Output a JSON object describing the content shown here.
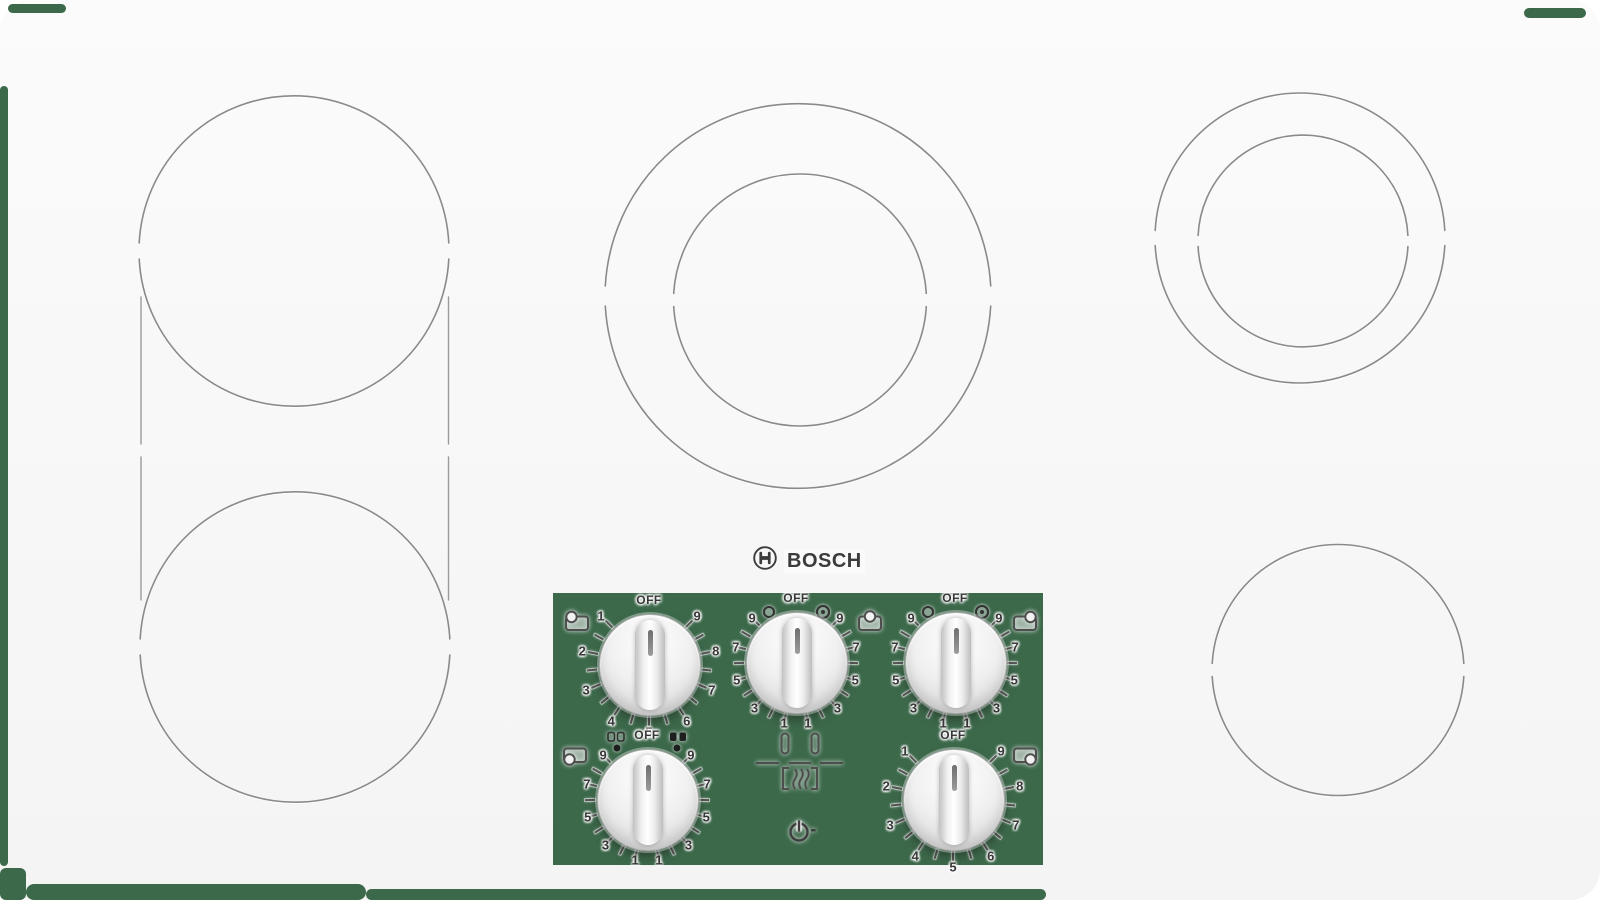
{
  "brand": {
    "name": "BOSCH",
    "icon": "bosch-armature-icon"
  },
  "colors": {
    "surface": "#e6e6e6",
    "frame": "#f9f9f9",
    "ring_line": "#8a8a8a",
    "transparency_green": "#3d694b",
    "label_text": "#383838"
  },
  "burners": [
    {
      "name": "left-rear",
      "style": "single ring, bridge-linked to left-front"
    },
    {
      "name": "left-front",
      "style": "single ring, bridge-linked to left-rear"
    },
    {
      "name": "center",
      "style": "double concentric ring"
    },
    {
      "name": "right-rear",
      "style": "double concentric ring"
    },
    {
      "name": "right-front",
      "style": "single ring"
    }
  ],
  "control_panel": {
    "off_label": "OFF",
    "knobs": [
      {
        "name": "left-rear-knob",
        "burner_icon": "burner-position-top-left-icon",
        "scale": "single",
        "labels": [
          "1",
          "2",
          "3",
          "4",
          "5",
          "6",
          "7",
          "8",
          "9"
        ]
      },
      {
        "name": "center-knob",
        "burner_icon": "burner-position-top-center-icon",
        "scale": "dual",
        "labels": [
          "9",
          "7",
          "5",
          "3",
          "1",
          "9",
          "7",
          "5",
          "3",
          "1"
        ],
        "left_marker": "single-zone-circle-icon",
        "right_marker": "dual-zone-double-circle-icon"
      },
      {
        "name": "right-rear-knob",
        "burner_icon": "burner-position-top-right-icon",
        "scale": "dual",
        "labels": [
          "9",
          "7",
          "5",
          "3",
          "1",
          "9",
          "7",
          "5",
          "3",
          "1"
        ],
        "left_marker": "single-zone-circle-icon",
        "right_marker": "dual-zone-double-circle-icon"
      },
      {
        "name": "left-front-knob",
        "burner_icon": "burner-position-bottom-left-icon",
        "scale": "dual",
        "labels": [
          "9",
          "7",
          "5",
          "3",
          "1",
          "9",
          "7",
          "5",
          "3",
          "1"
        ],
        "left_marker": "bridge-open-icon",
        "right_marker": "bridge-closed-icon",
        "has_dots": true
      },
      {
        "name": "right-front-knob",
        "burner_icon": "burner-position-bottom-right-icon",
        "scale": "single",
        "labels": [
          "1",
          "2",
          "3",
          "4",
          "5",
          "6",
          "7",
          "8",
          "9"
        ]
      }
    ],
    "icons": [
      "power-indicator-icon",
      "bridge-element-diagram"
    ]
  }
}
